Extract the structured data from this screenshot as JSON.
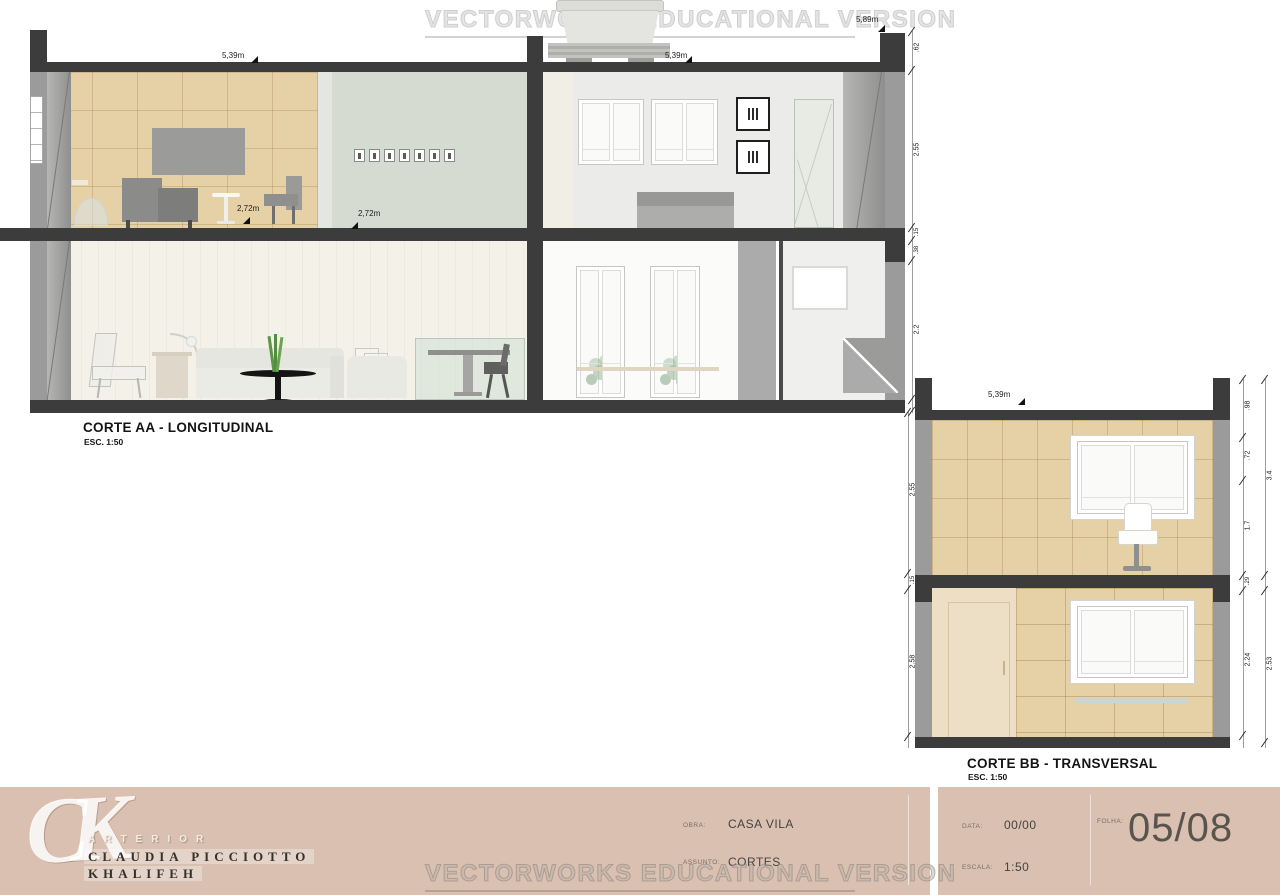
{
  "watermark": {
    "text": "VECTORWORKS EDUCATIONAL VERSION"
  },
  "sections": {
    "aa": {
      "title": "CORTE AA - LONGITUDINAL",
      "scale": "ESC. 1:50",
      "dim_top_left": "5,39m",
      "dim_top_mid": "5,39m",
      "dim_top_right": "5,89m",
      "dim_room_left": "2,72m",
      "dim_room_mid": "2,72m",
      "right_dims": [
        ".62",
        "2.55",
        ".15",
        ".38",
        "2.2"
      ]
    },
    "bb": {
      "title": "CORTE BB - TRANSVERSAL",
      "scale": "ESC. 1:50",
      "dim_top": "5,39m",
      "left_dims": [
        "2.55",
        ".15",
        "2.58"
      ],
      "right_inner_dims": [
        ".98",
        ".72",
        "1.7",
        ".29",
        "2.24"
      ],
      "right_outer_dims": [
        "3.4",
        "2.53"
      ]
    }
  },
  "titleblock": {
    "logo": "CK",
    "brand": "ARTERIOR",
    "author_line1": "CLAUDIA PICCIOTTO",
    "author_line2": "KHALIFEH",
    "obra_label": "OBRA:",
    "obra_value": "CASA VILA",
    "assunto_label": "ASSUNTO:",
    "assunto_value": "CORTES",
    "data_label": "DATA:",
    "data_value": "00/00",
    "escala_label": "ESCALA:",
    "escala_value": "1:50",
    "folha_label": "FOLHA:",
    "folha_value": "05/08",
    "bg_color": "#d9c0b1"
  },
  "colors": {
    "wall_dark": "#3d3c3c",
    "wall_gray": "#9b9b9b",
    "panel_tan": "#e6d0a6",
    "wall_green": "#d6dbd1",
    "living_cream": "#f4f1e9",
    "titleblock_bg": "#d9c0b1",
    "watermark_gray": "#d6d6d6"
  }
}
